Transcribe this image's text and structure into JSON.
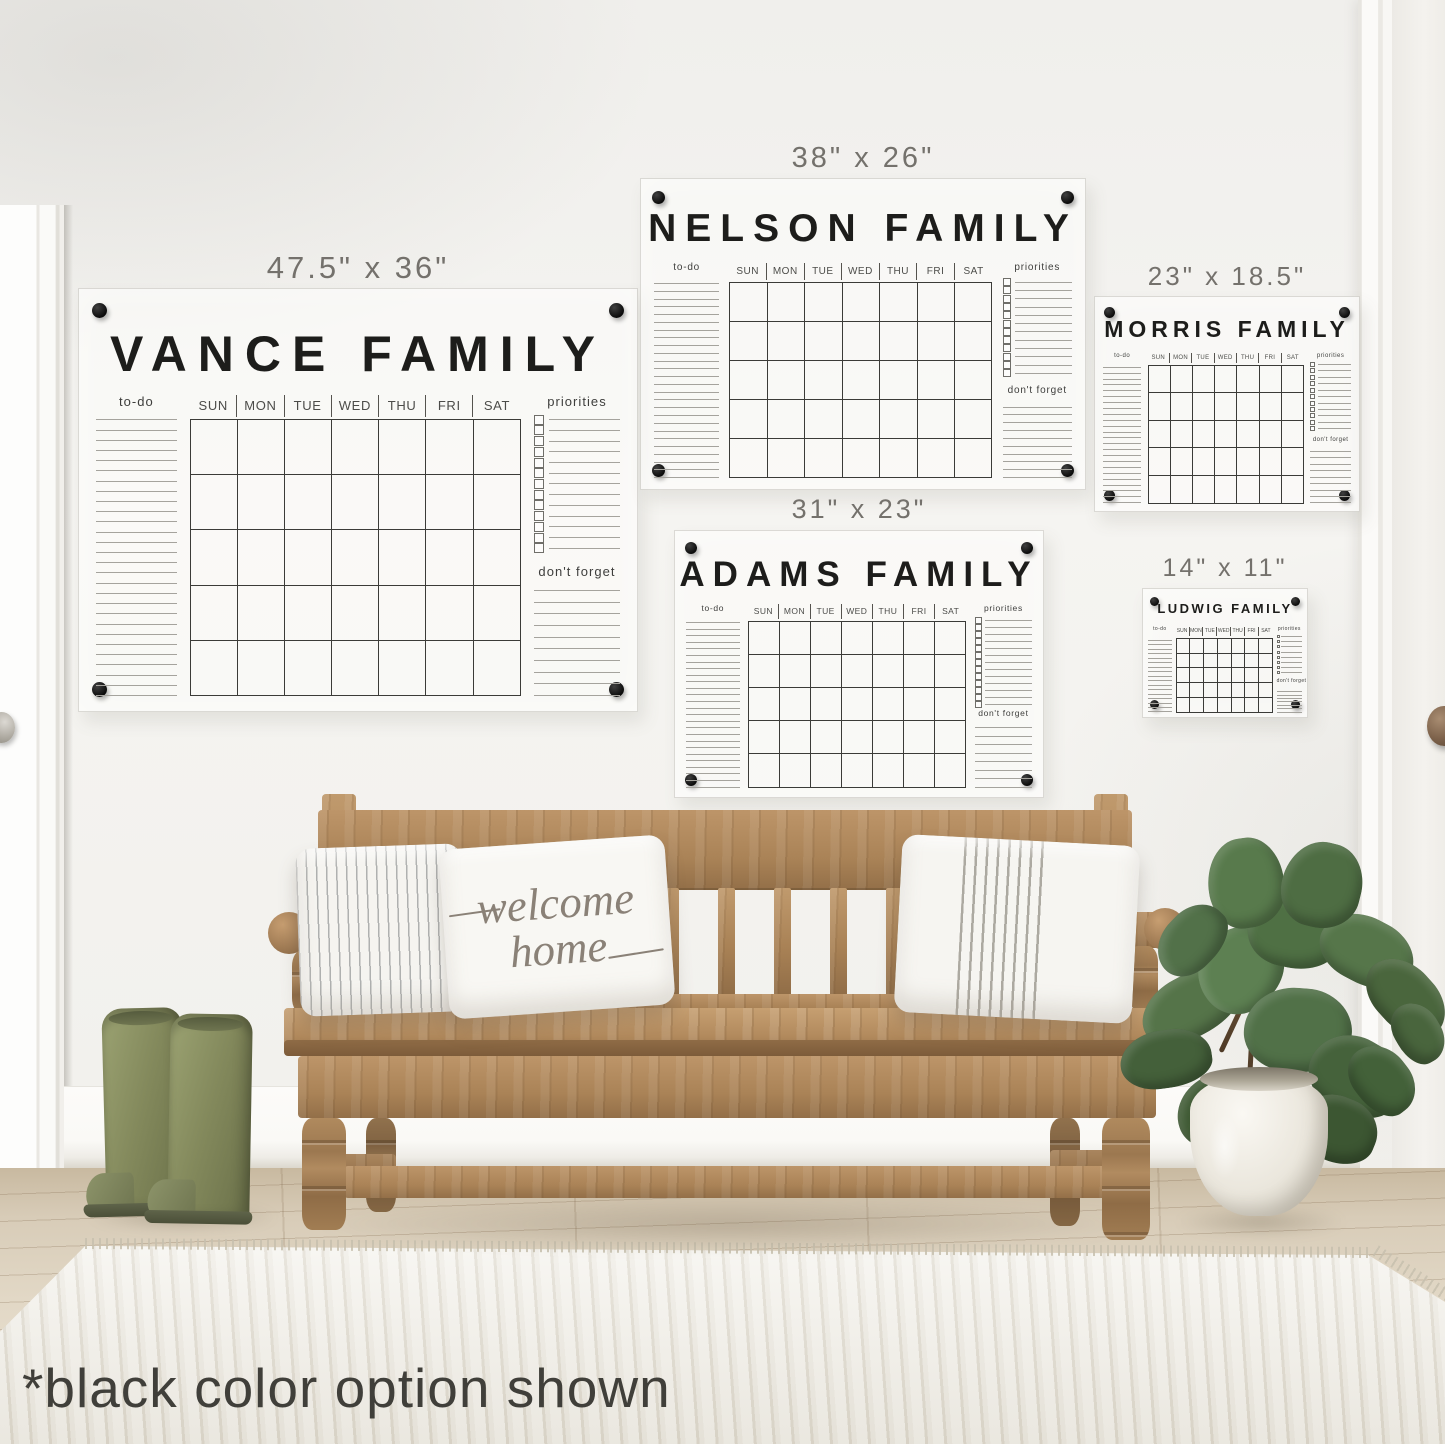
{
  "note_text": "*black color option shown",
  "welcome_pillow": {
    "line1": "welcome",
    "line2": "home"
  },
  "board_labels": {
    "todo": "to-do",
    "priorities": "priorities",
    "dont_forget": "don't forget",
    "days": [
      "SUN",
      "MON",
      "TUE",
      "WED",
      "THU",
      "FRI",
      "SAT"
    ]
  },
  "calendars": [
    {
      "name": "VANCE FAMILY",
      "size": "47.5\" x 36\""
    },
    {
      "name": "NELSON FAMILY",
      "size": "38\" x 26\""
    },
    {
      "name": "MORRIS FAMILY",
      "size": "23\" x 18.5\""
    },
    {
      "name": "ADAMS FAMILY",
      "size": "31\" x 23\""
    },
    {
      "name": "LUDWIG FAMILY",
      "size": "14\" x 11\""
    }
  ],
  "palette": {
    "print_black": "#1d1d1b",
    "label_gray": "#74716c",
    "wall": "#f3f2ef",
    "bench_wood": "#b08a5e",
    "floor_wood": "#ddd2bf",
    "rug_cream": "#eeebe3",
    "boots_green": "#83895c",
    "leaf_green": "#4f7044",
    "knob_silver": "#b2aea6",
    "knob_bronze": "#7d624b"
  }
}
